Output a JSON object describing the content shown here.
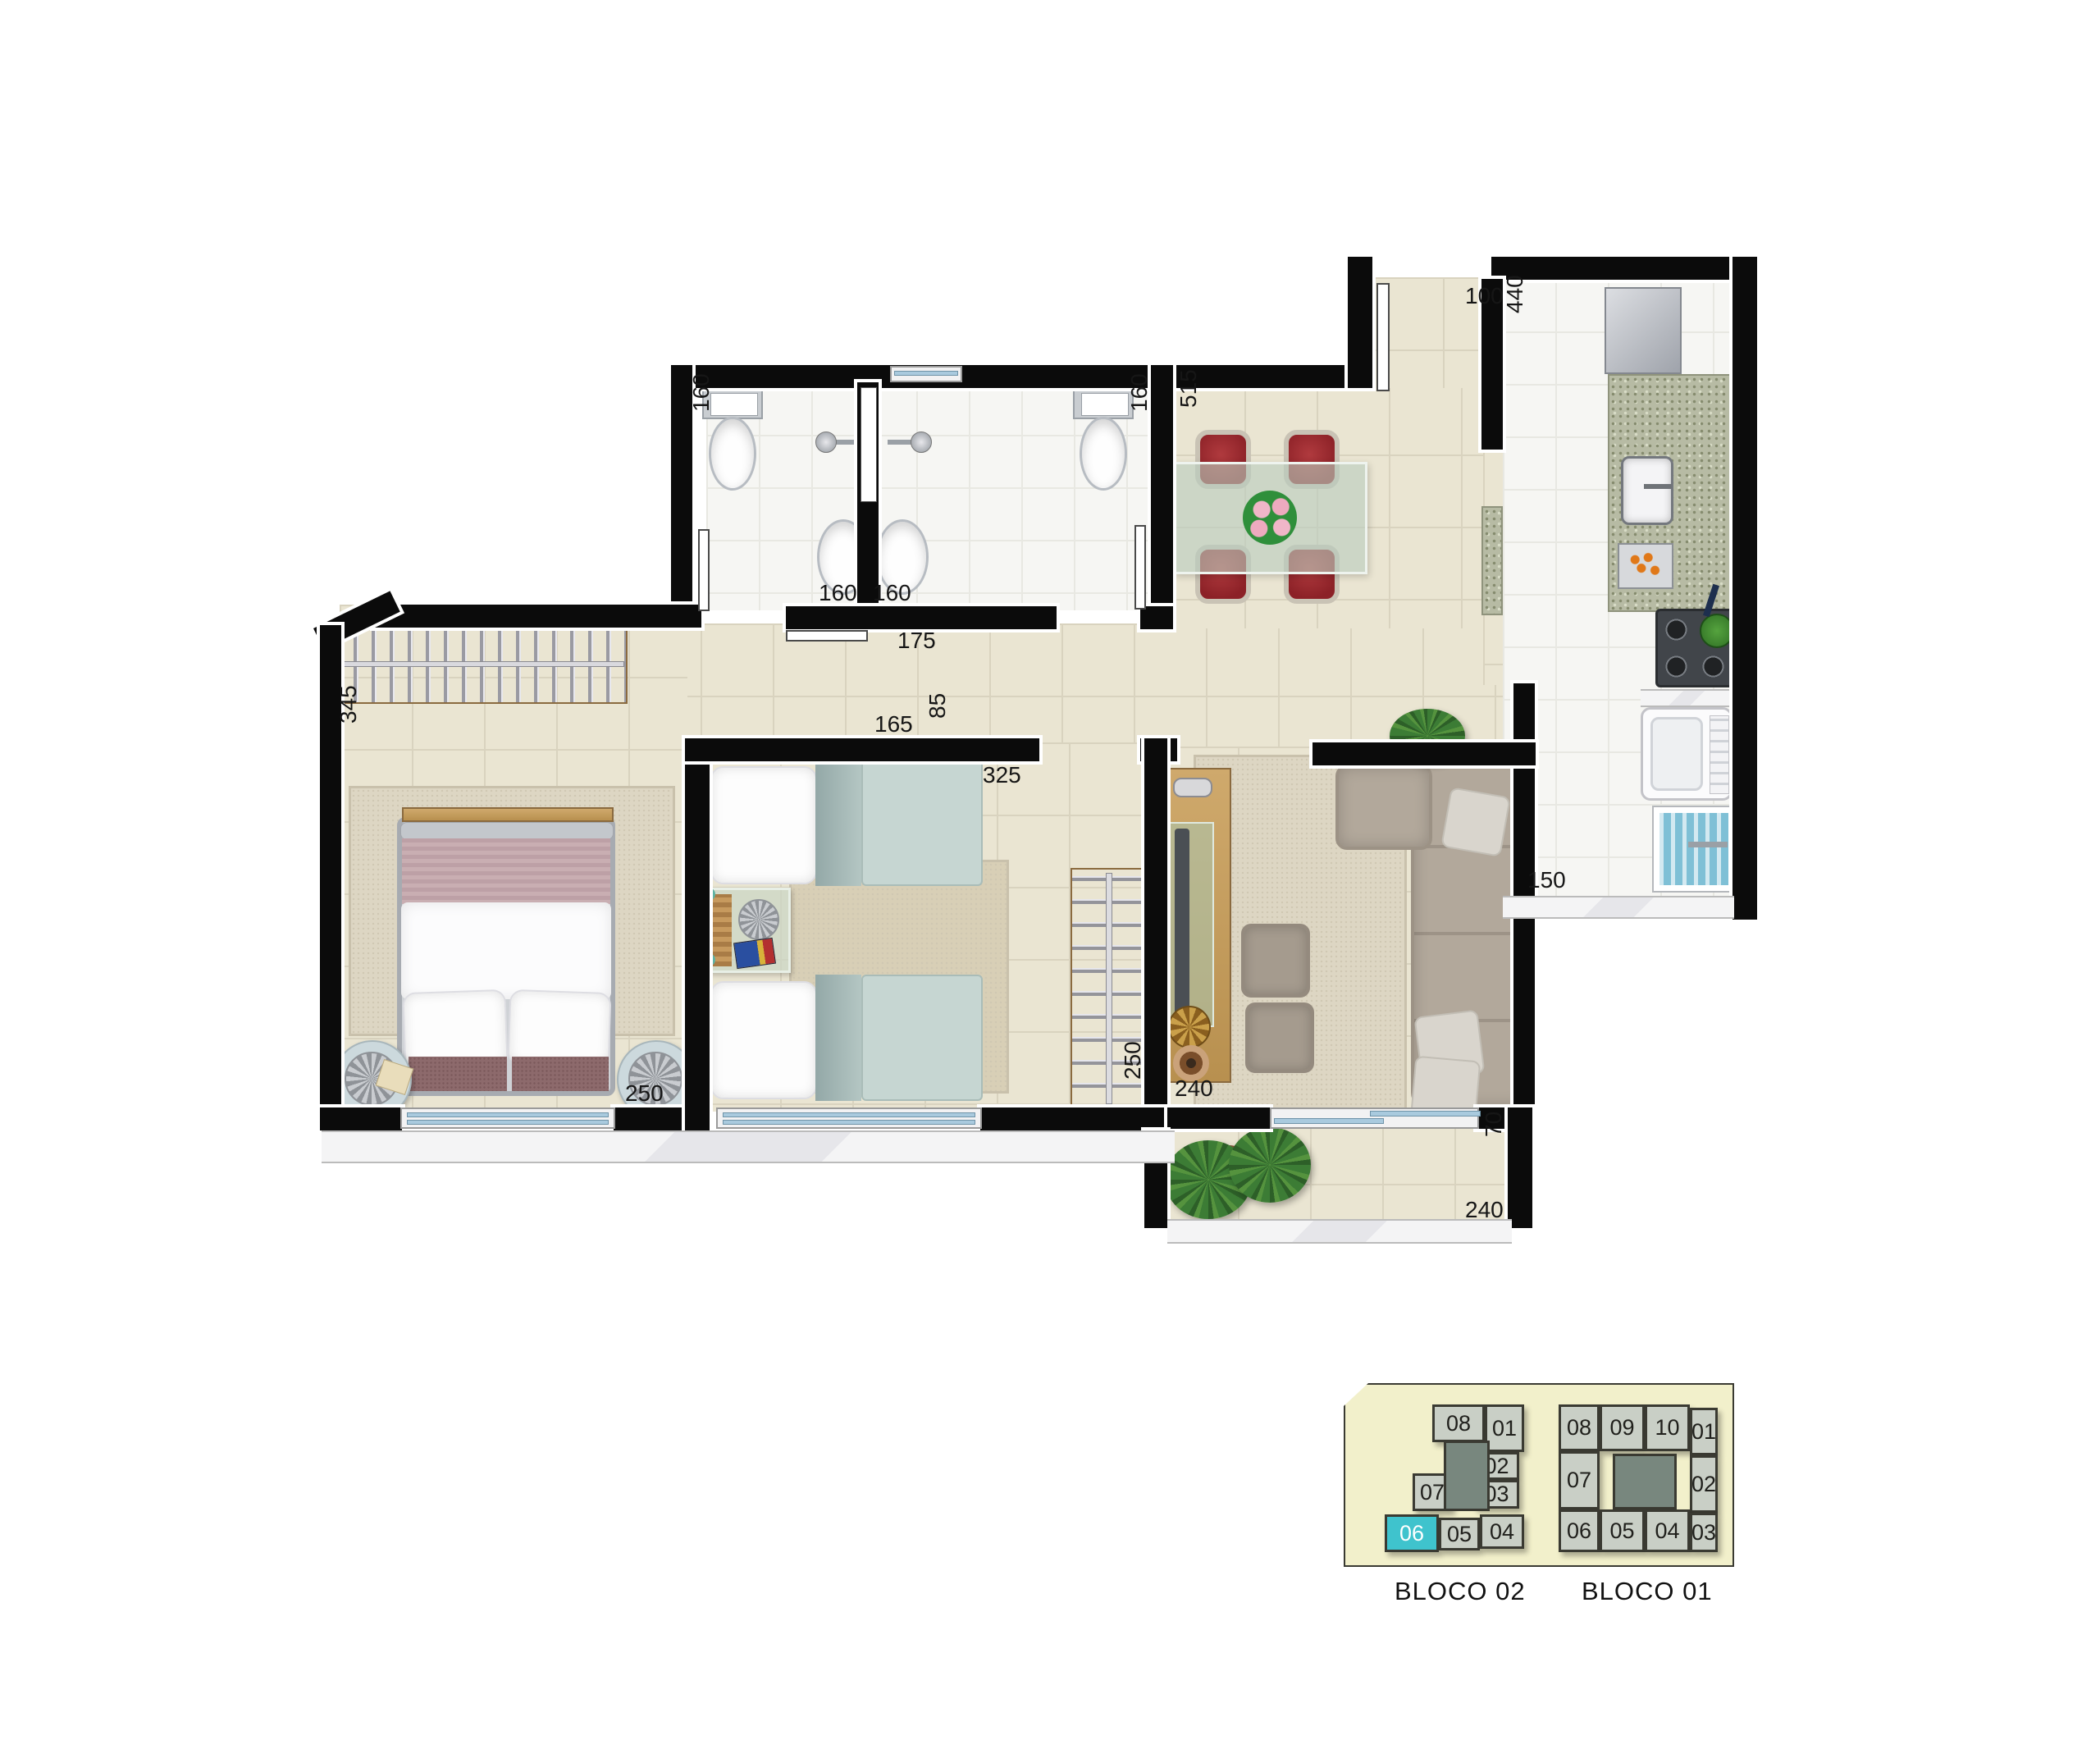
{
  "plan": {
    "labels": {
      "entry_width": "100",
      "kitchen_length": "440",
      "bathroom_left_width": "160",
      "bathroom_right_width": "160",
      "dining_length": "515",
      "sink_left": "160",
      "sink_right": "160",
      "hall_door": "175",
      "bedroom2_wall": "165",
      "bedroom2_door": "85",
      "bedroom2_width": "325",
      "master_width": "345",
      "master_length": "250",
      "wardrobe_length": "250",
      "living_width": "240",
      "service_width": "150",
      "balcony_depth": "70",
      "balcony_length": "240"
    }
  },
  "key_plan": {
    "bloco02": {
      "label": "BLOCO 02",
      "highlighted_unit": "06",
      "units": {
        "u08": "08",
        "u01": "01",
        "u02": "02",
        "u03": "03",
        "u07": "07",
        "u06": "06",
        "u05": "05",
        "u04": "04"
      }
    },
    "bloco01": {
      "label": "BLOCO 01",
      "units": {
        "u08": "08",
        "u09": "09",
        "u10": "10",
        "u01": "01",
        "u07": "07",
        "u02": "02",
        "u06": "06",
        "u05": "05",
        "u04": "04",
        "u03": "03"
      }
    }
  },
  "colors": {
    "wall": "#0b0b0b",
    "floor_main": "#eae5d2",
    "floor_wet": "#f6f6f3",
    "window_glass": "#a9cade",
    "chair_red": "#9e2b30",
    "key_plan_bg": "#f2f0cb",
    "key_plan_unit": "#c9cfc6",
    "key_plan_core": "#78877e",
    "highlight_unit": "#3fc3cd"
  }
}
